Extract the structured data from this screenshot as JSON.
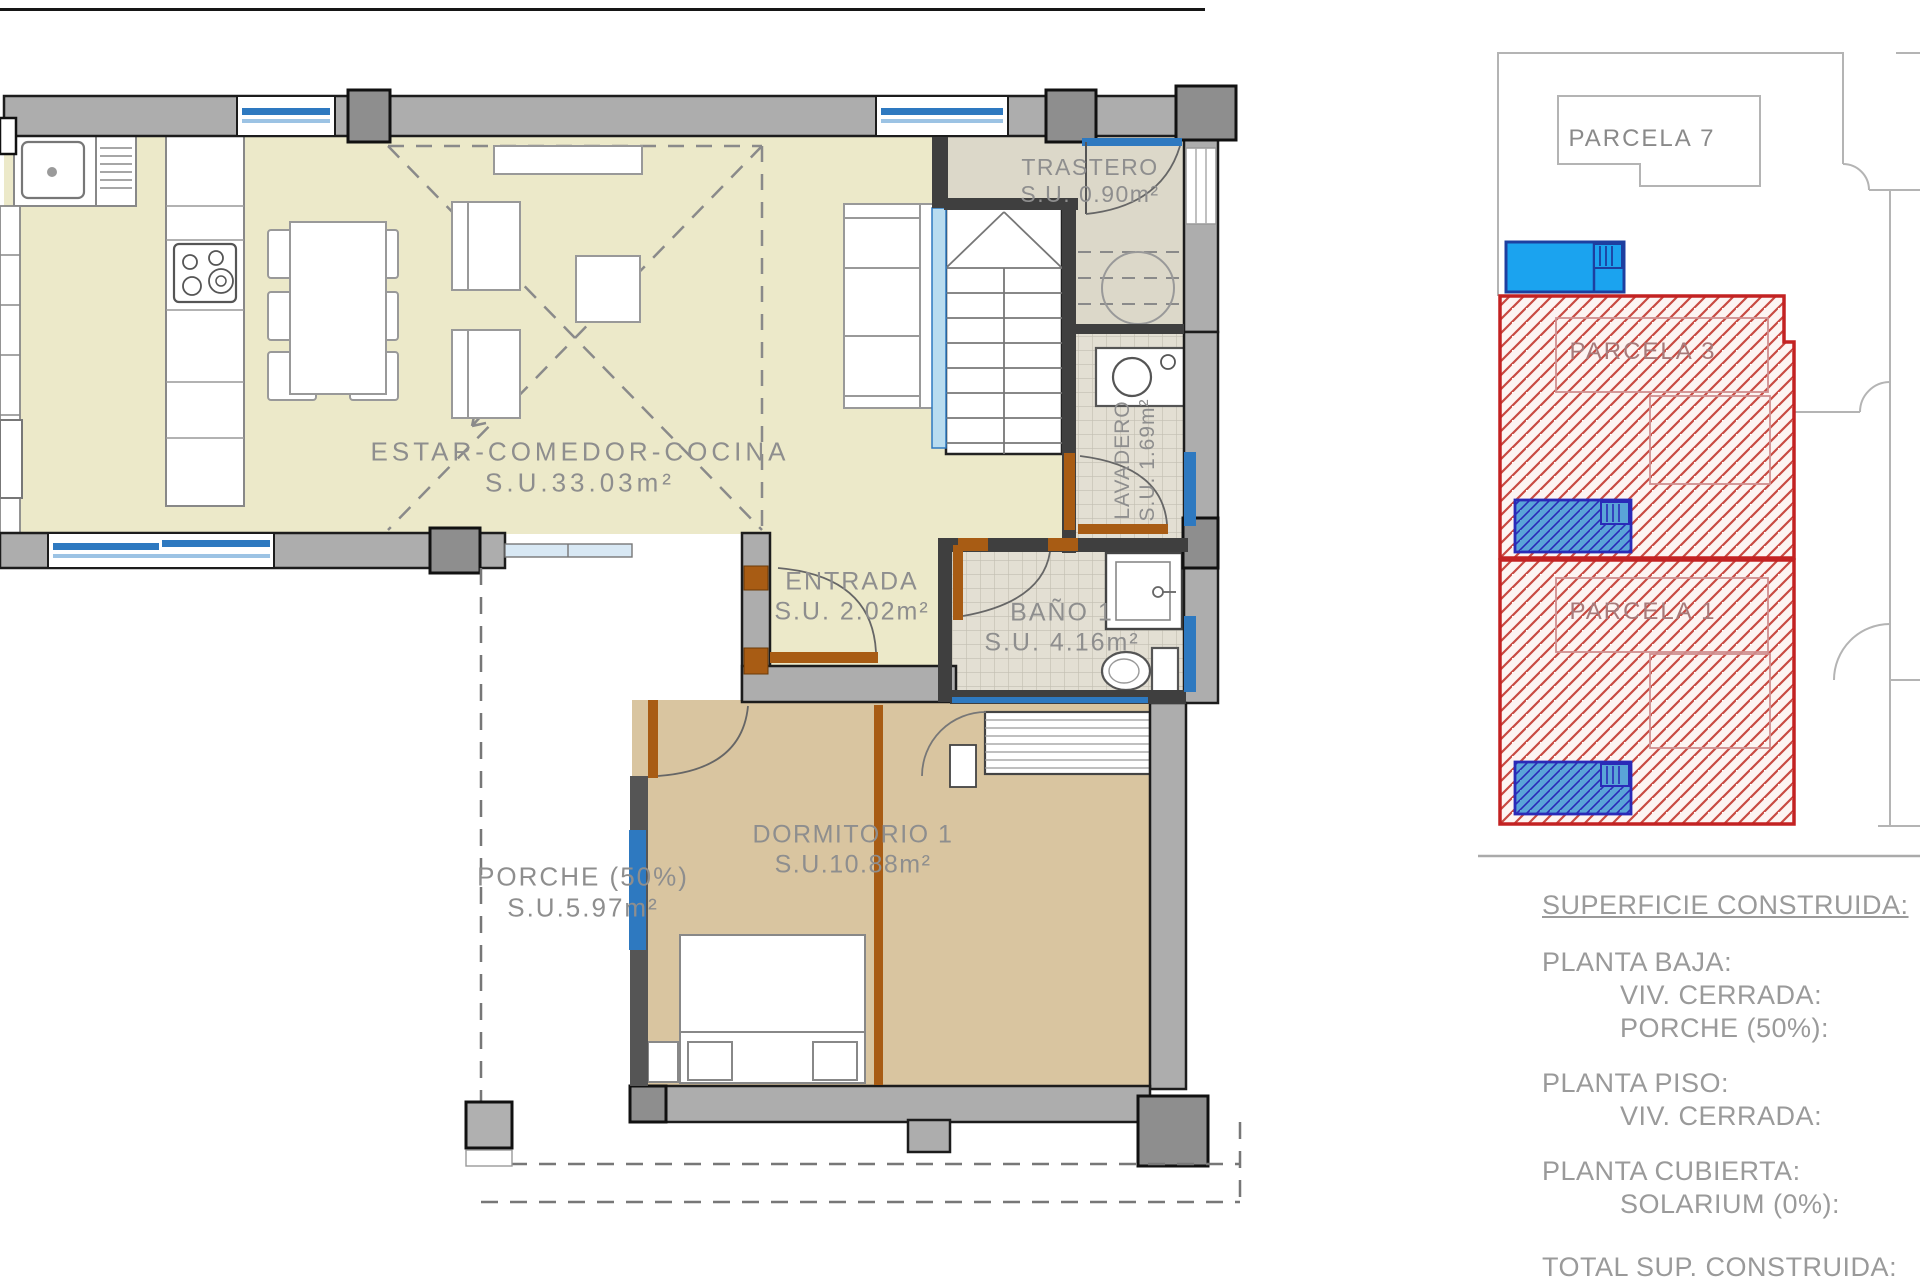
{
  "floor_plan": {
    "rooms": {
      "estar": {
        "name": "ESTAR-COMEDOR-COCINA",
        "area": "S.U.33.03m²"
      },
      "trastero": {
        "name": "TRASTERO",
        "area": "S.U. 0.90m²"
      },
      "lavadero": {
        "name": "LAVADERO",
        "area": "S.U. 1.69m²"
      },
      "entrada": {
        "name": "ENTRADA",
        "area": "S.U. 2.02m²"
      },
      "bano": {
        "name": "BAÑO 1",
        "area": "S.U. 4.16m²"
      },
      "dormitorio": {
        "name": "DORMITORIO 1",
        "area": "S.U.10.88m²"
      },
      "porche": {
        "name": "PORCHE (50%)",
        "area": "S.U.5.97m²"
      }
    }
  },
  "site_plan": {
    "parcels": [
      {
        "label": "PARCELA 7",
        "highlighted": false
      },
      {
        "label": "PARCELA 3",
        "highlighted": true
      },
      {
        "label": "PARCELA 1",
        "highlighted": true
      }
    ]
  },
  "legend": {
    "title": "SUPERFICIE CONSTRUIDA:",
    "sections": [
      {
        "heading": "PLANTA BAJA:",
        "items": [
          "VIV. CERRADA:",
          "PORCHE (50%):"
        ]
      },
      {
        "heading": "PLANTA PISO:",
        "items": [
          "VIV. CERRADA:"
        ]
      },
      {
        "heading": "PLANTA CUBIERTA:",
        "items": [
          "SOLARIUM (0%):"
        ]
      }
    ],
    "total_label": "TOTAL SUP. CONSTRUIDA:"
  },
  "colors": {
    "living_floor": "#ece9c9",
    "bedroom_floor": "#d9c5a0",
    "utility_floor": "#dcd8c9",
    "wall_gray": "#adadad",
    "window_blue": "#2e79c0",
    "door_brown": "#a85c14",
    "parcel_red": "#c32222",
    "pool_blue": "#1ba3ef"
  }
}
